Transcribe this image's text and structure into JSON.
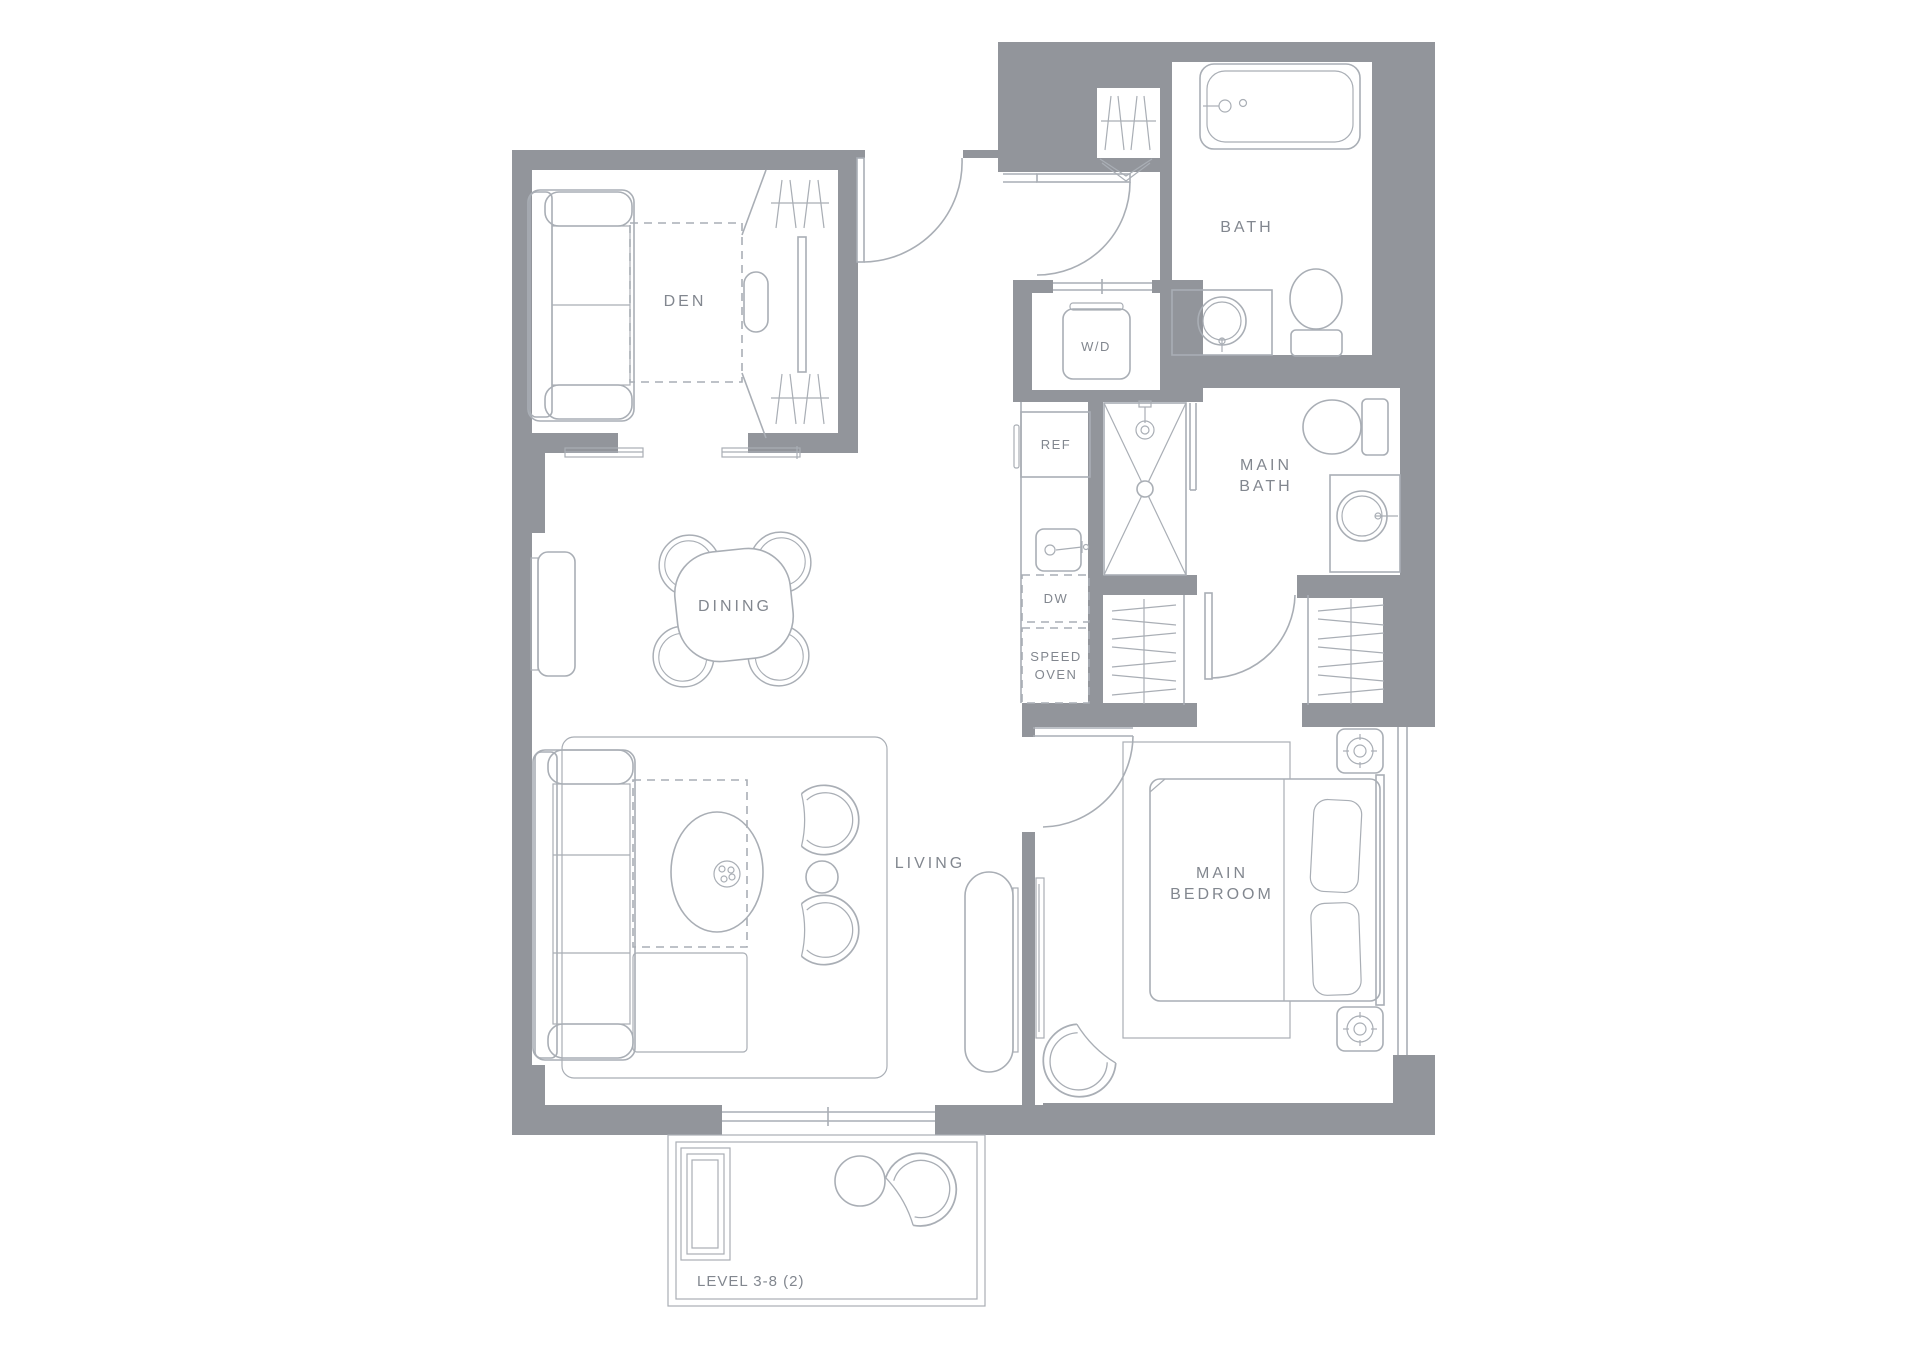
{
  "rooms": {
    "den": "DEN",
    "bath": "BATH",
    "main_bath_line1": "MAIN",
    "main_bath_line2": "BATH",
    "dining": "DINING",
    "living": "LIVING",
    "main_bedroom_line1": "MAIN",
    "main_bedroom_line2": "BEDROOM"
  },
  "appliances": {
    "washer_dryer": "W/D",
    "fridge": "REF",
    "dishwasher": "DW",
    "speed_oven_line1": "SPEED",
    "speed_oven_line2": "OVEN"
  },
  "footer": {
    "level_label": "LEVEL 3-8 (2)"
  },
  "colors": {
    "wall": "#92959b",
    "line": "#a9aeb5",
    "text": "#82878f",
    "background": "#ffffff"
  }
}
